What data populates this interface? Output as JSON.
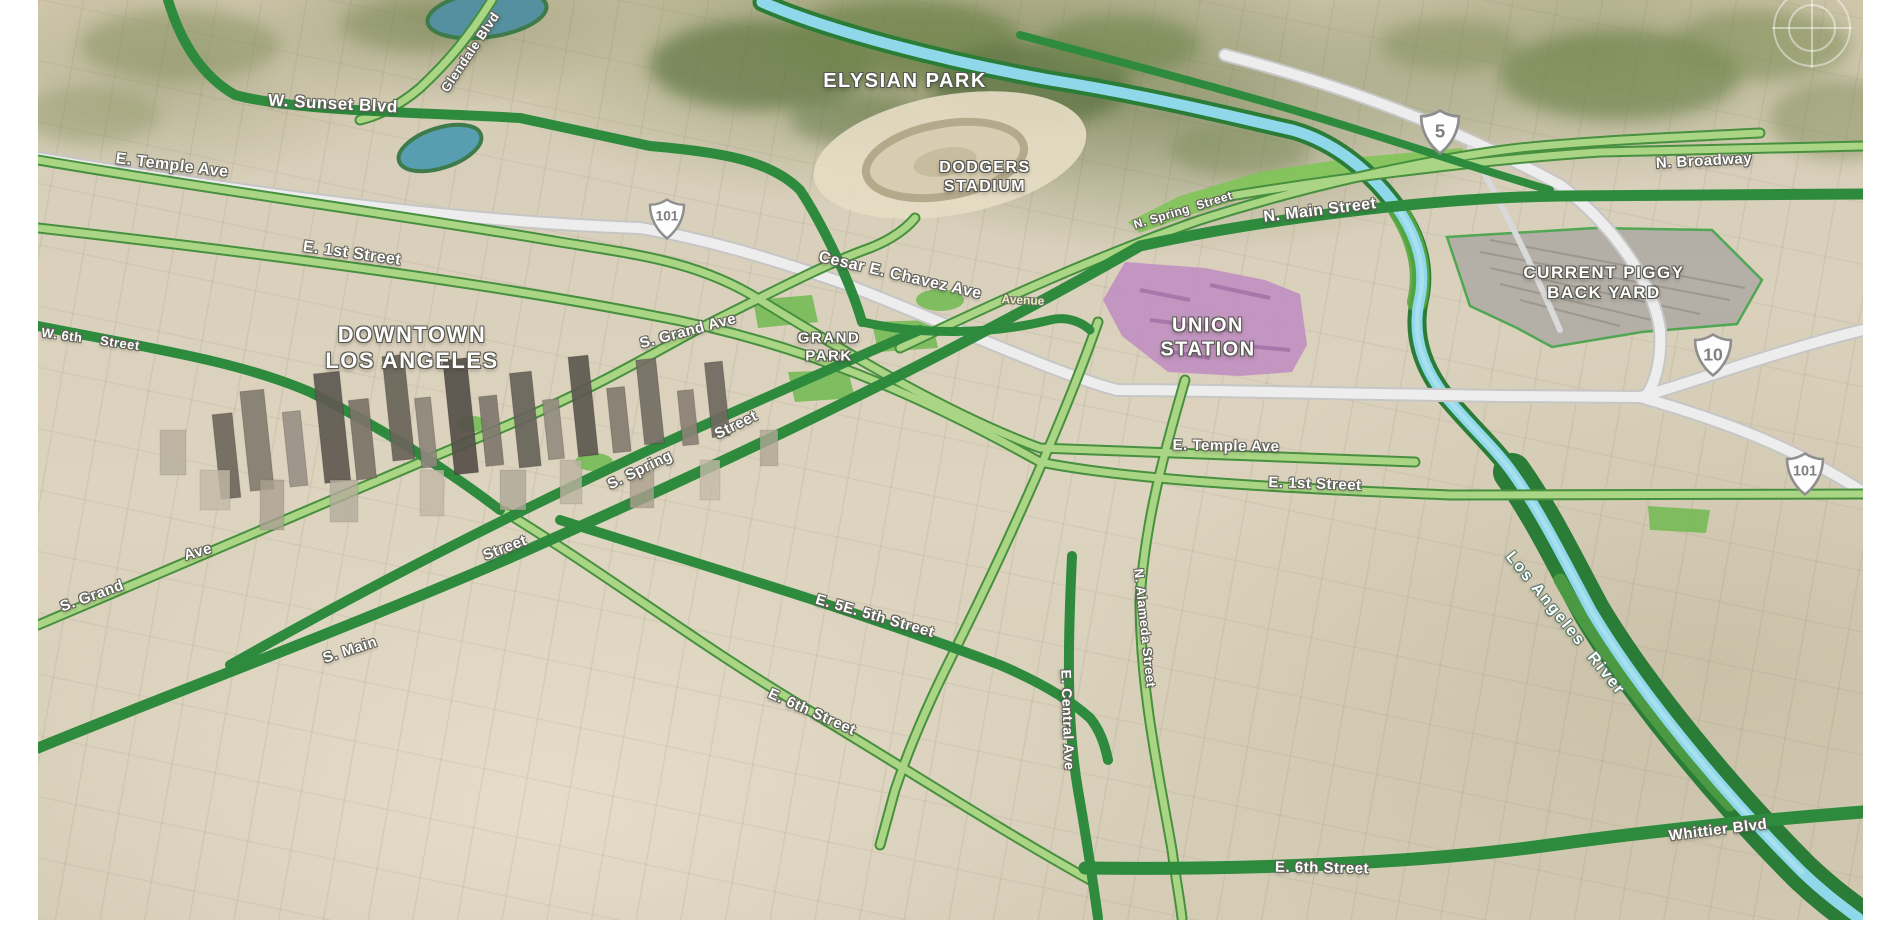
{
  "labels": {
    "places": [
      {
        "name": "label-elysian-park",
        "lines": [
          "ELYSIAN PARK"
        ],
        "x": 905,
        "y": 82,
        "rot": 0,
        "size": 20
      },
      {
        "name": "label-dodgers-stadium",
        "lines": [
          "DODGERS",
          "STADIUM"
        ],
        "x": 985,
        "y": 178,
        "rot": 0,
        "size": 16
      },
      {
        "name": "label-downtown-los-angeles",
        "lines": [
          "DOWNTOWN",
          "LOS ANGELES"
        ],
        "x": 412,
        "y": 348,
        "rot": 0,
        "size": 22
      },
      {
        "name": "label-grand-park",
        "lines": [
          "GRAND",
          "PARK"
        ],
        "x": 829,
        "y": 347,
        "rot": 0,
        "size": 15
      },
      {
        "name": "label-union-station",
        "lines": [
          "UNION",
          "STATION"
        ],
        "x": 1208,
        "y": 338,
        "rot": 0,
        "size": 20
      },
      {
        "name": "label-current-piggy-back-yard",
        "lines": [
          "CURRENT PIGGY",
          "BACK YARD"
        ],
        "x": 1604,
        "y": 283,
        "rot": 0,
        "size": 17
      }
    ],
    "streets": [
      {
        "name": "label-w-sunset-blvd",
        "text": "W. Sunset Blvd",
        "x": 333,
        "y": 104,
        "rot": 3,
        "size": 17
      },
      {
        "name": "label-glendale-blvd",
        "text": "Glendale Blvd",
        "x": 470,
        "y": 52,
        "rot": -56,
        "size": 13
      },
      {
        "name": "label-e-temple-ave-west",
        "text": "E. Temple Ave",
        "x": 172,
        "y": 166,
        "rot": 7,
        "size": 16
      },
      {
        "name": "label-e-1st-street-west",
        "text": "E. 1st Street",
        "x": 352,
        "y": 254,
        "rot": 8,
        "size": 16
      },
      {
        "name": "label-w-6th",
        "text": "W. 6th",
        "x": 62,
        "y": 335,
        "rot": 8,
        "size": 13
      },
      {
        "name": "label-w-6th-street-word",
        "text": "Street",
        "x": 120,
        "y": 343,
        "rot": 8,
        "size": 13
      },
      {
        "name": "label-cesar-e-chavez-ave",
        "text": "Cesar E. Chavez Ave",
        "x": 900,
        "y": 276,
        "rot": 13,
        "size": 16
      },
      {
        "name": "label-n-spring-street",
        "text": "N. Spring  Street",
        "x": 1183,
        "y": 210,
        "rot": -17,
        "size": 12
      },
      {
        "name": "label-n-main-street",
        "text": "N. Main Street",
        "x": 1320,
        "y": 211,
        "rot": -7,
        "size": 16
      },
      {
        "name": "label-n-broadway",
        "text": "N. Broadway",
        "x": 1704,
        "y": 161,
        "rot": -3,
        "size": 15
      },
      {
        "name": "label-s-grand-ave",
        "text": "S. Grand Ave",
        "x": 688,
        "y": 331,
        "rot": -15,
        "size": 15
      },
      {
        "name": "label-s-spring",
        "text": "S. Spring",
        "x": 640,
        "y": 470,
        "rot": -26,
        "size": 15
      },
      {
        "name": "label-s-spring-street-word",
        "text": "Street",
        "x": 736,
        "y": 425,
        "rot": -26,
        "size": 15
      },
      {
        "name": "label-s-grand-lower",
        "text": "S. Grand",
        "x": 92,
        "y": 596,
        "rot": -20,
        "size": 15
      },
      {
        "name": "label-ave-lower",
        "text": "Ave",
        "x": 198,
        "y": 552,
        "rot": -16,
        "size": 15
      },
      {
        "name": "label-s-main",
        "text": "S. Main",
        "x": 350,
        "y": 650,
        "rot": -18,
        "size": 15
      },
      {
        "name": "label-s-main-street-word",
        "text": "Street",
        "x": 505,
        "y": 548,
        "rot": -21,
        "size": 15
      },
      {
        "name": "label-e-temple-ave-east",
        "text": "E. Temple Ave",
        "x": 1226,
        "y": 446,
        "rot": 1,
        "size": 15
      },
      {
        "name": "label-e-1st-street-east",
        "text": "E. 1st Street",
        "x": 1315,
        "y": 484,
        "rot": 2,
        "size": 15
      },
      {
        "name": "label-e-5th-street",
        "text": "E. 5E. 5th Street",
        "x": 875,
        "y": 616,
        "rot": 16,
        "size": 15
      },
      {
        "name": "label-e-6th-street-west",
        "text": "E. 6th Street",
        "x": 812,
        "y": 712,
        "rot": 24,
        "size": 15
      },
      {
        "name": "label-e-central-ave",
        "text": "E. Central Ave",
        "x": 1068,
        "y": 720,
        "rot": 88,
        "size": 14
      },
      {
        "name": "label-n-alameda-street",
        "text": "N. Alameda Street",
        "x": 1145,
        "y": 628,
        "rot": 84,
        "size": 13
      },
      {
        "name": "label-e-6th-street-east",
        "text": "E. 6th Street",
        "x": 1322,
        "y": 868,
        "rot": 1,
        "size": 15
      },
      {
        "name": "label-whittier-blvd",
        "text": "Whittier Blvd",
        "x": 1718,
        "y": 830,
        "rot": -7,
        "size": 15
      }
    ],
    "basemap": [
      {
        "name": "label-avenue",
        "text": "Avenue",
        "x": 1023,
        "y": 300,
        "rot": 3,
        "size": 12
      }
    ],
    "water": [
      {
        "name": "label-los-angeles-river",
        "text": "Los Angeles  River",
        "x": 1565,
        "y": 624,
        "rot": 51,
        "size": 16
      }
    ]
  },
  "shields": [
    {
      "route": "101",
      "x": 667,
      "y": 219,
      "w": 38
    },
    {
      "route": "5",
      "x": 1440,
      "y": 132,
      "w": 42
    },
    {
      "route": "10",
      "x": 1713,
      "y": 355,
      "w": 40
    },
    {
      "route": "101",
      "x": 1805,
      "y": 474,
      "w": 40
    }
  ],
  "colors": {
    "arterial_dark_green": "#2E8B3E",
    "road_light_green": "#A8D484",
    "road_green_casing": "#47903F",
    "freeway_fill": "#EDEDED",
    "river_cyan": "#8FD9EA",
    "river_bank_green": "#2A7C36",
    "park_green": "#6FBA50",
    "union_station_purple": "#C18FC1",
    "rail_yard_gray": "#B2AEA6",
    "terrain_tan": "#D8CFBA"
  }
}
